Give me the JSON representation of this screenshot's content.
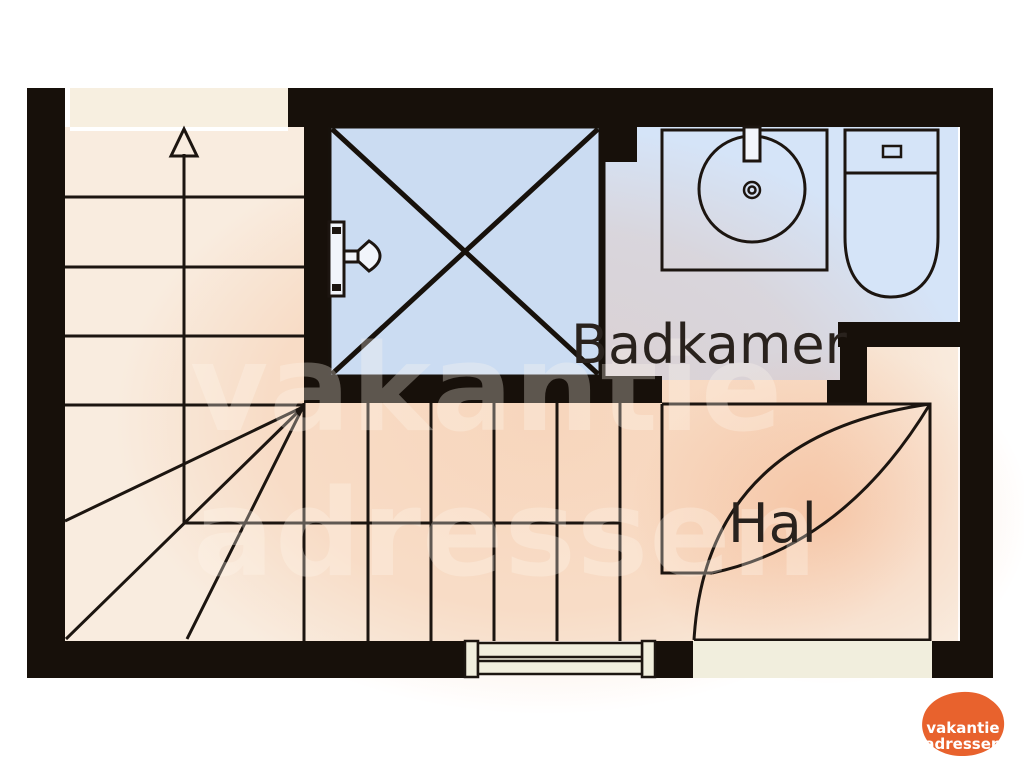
{
  "rooms": [
    {
      "id": "badkamer",
      "label": "Badkamer"
    },
    {
      "id": "hal",
      "label": "Hal"
    }
  ],
  "fixtures": [
    "staircase-with-winders",
    "up-arrow",
    "shower",
    "shower-head",
    "sink",
    "toilet",
    "door-swing",
    "window",
    "threshold"
  ],
  "watermark": {
    "line1": "vakantie",
    "line2": "adressen"
  },
  "logo": {
    "line1": "vakantie",
    "line2": "adressen"
  },
  "colors": {
    "wall": "#17100a",
    "floor": "#f9ecdf",
    "landing": "#f7efe0",
    "bathroom_floor": "#d5e4f8",
    "shower_floor": "#cbdcf2",
    "line": "#1c1510",
    "threshold": "#f1eedd",
    "logo_orange": "#e8622d",
    "label_text": "#29221d",
    "watermark_tint": "rgba(240,125,50,0.18)"
  }
}
